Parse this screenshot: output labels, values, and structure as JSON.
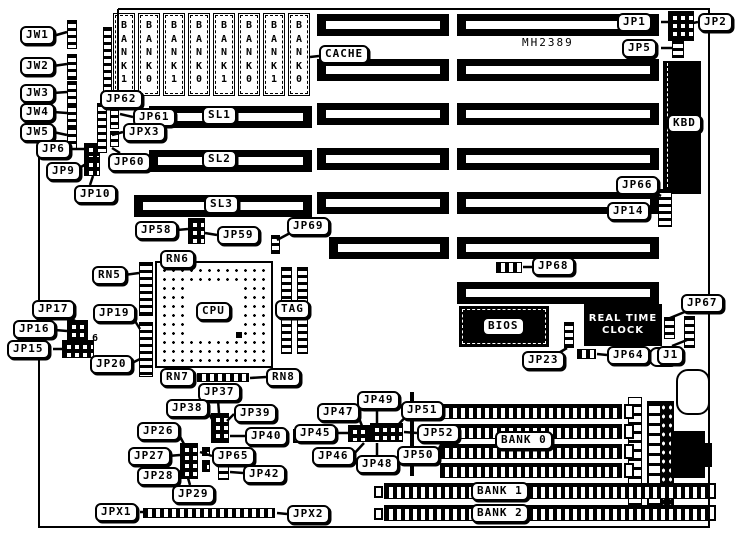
{
  "board": {
    "model_text": "MH2389"
  },
  "labels": {
    "rtc_line1": "REAL TIME",
    "rtc_line2": "CLOCK",
    "pin6": "6"
  },
  "memory": {
    "simm_slots": [
      "BANK1",
      "BANK0",
      "BANK1",
      "BANK0",
      "BANK1",
      "BANK0",
      "BANK1",
      "BANK0"
    ]
  },
  "callouts": [
    {
      "text": "JW1",
      "x": 20,
      "y": 26,
      "leader": [
        53,
        36,
        67,
        32
      ]
    },
    {
      "text": "JW2",
      "x": 20,
      "y": 57,
      "leader": [
        53,
        66,
        67,
        64
      ]
    },
    {
      "text": "JW3",
      "x": 20,
      "y": 84,
      "leader": [
        53,
        93,
        67,
        92
      ]
    },
    {
      "text": "JW4",
      "x": 20,
      "y": 103,
      "leader": [
        53,
        112,
        67,
        113
      ]
    },
    {
      "text": "JW5",
      "x": 20,
      "y": 123,
      "leader": [
        53,
        132,
        67,
        135
      ]
    },
    {
      "text": "JP6",
      "x": 36,
      "y": 140,
      "leader": [
        70,
        149,
        84,
        149
      ]
    },
    {
      "text": "JP9",
      "x": 46,
      "y": 162,
      "leader": [
        76,
        170,
        86,
        164
      ]
    },
    {
      "text": "JP10",
      "x": 74,
      "y": 185,
      "leader": [
        90,
        185,
        93,
        176
      ]
    },
    {
      "text": "JP62",
      "x": 100,
      "y": 90,
      "leader": null
    },
    {
      "text": "JP61",
      "x": 133,
      "y": 108,
      "leader": [
        133,
        117,
        120,
        114
      ]
    },
    {
      "text": "JPX3",
      "x": 123,
      "y": 123,
      "leader": [
        123,
        132,
        112,
        135
      ]
    },
    {
      "text": "JP60",
      "x": 108,
      "y": 153,
      "leader": [
        120,
        153,
        112,
        148
      ]
    },
    {
      "text": "SL1",
      "x": 202,
      "y": 106,
      "leader": null
    },
    {
      "text": "SL2",
      "x": 202,
      "y": 150,
      "leader": null
    },
    {
      "text": "SL3",
      "x": 204,
      "y": 195,
      "leader": null
    },
    {
      "text": "CACHE",
      "x": 319,
      "y": 45,
      "leader": [
        319,
        56,
        310,
        57
      ]
    },
    {
      "text": "JP1",
      "x": 617,
      "y": 13,
      "leader": [
        661,
        22,
        668,
        22
      ]
    },
    {
      "text": "JP2",
      "x": 698,
      "y": 13,
      "leader": [
        698,
        22,
        693,
        23
      ]
    },
    {
      "text": "JP5",
      "x": 622,
      "y": 39,
      "leader": [
        661,
        48,
        672,
        48
      ]
    },
    {
      "text": "JP58",
      "x": 135,
      "y": 221,
      "leader": [
        177,
        230,
        188,
        229
      ]
    },
    {
      "text": "JP59",
      "x": 217,
      "y": 226,
      "leader": [
        217,
        235,
        205,
        233
      ]
    },
    {
      "text": "JP69",
      "x": 287,
      "y": 217,
      "leader": [
        292,
        232,
        277,
        240
      ]
    },
    {
      "text": "RN6",
      "x": 160,
      "y": 250,
      "leader": null
    },
    {
      "text": "RN5",
      "x": 92,
      "y": 266,
      "leader": [
        124,
        275,
        139,
        273
      ]
    },
    {
      "text": "JP17",
      "x": 32,
      "y": 300,
      "leader": [
        70,
        318,
        75,
        321
      ]
    },
    {
      "text": "JP19",
      "x": 93,
      "y": 304,
      "leader": [
        130,
        313,
        140,
        329
      ]
    },
    {
      "text": "JP16",
      "x": 13,
      "y": 320,
      "leader": [
        55,
        330,
        67,
        331
      ]
    },
    {
      "text": "JP15",
      "x": 7,
      "y": 340,
      "leader": [
        53,
        349,
        62,
        349
      ]
    },
    {
      "text": "JP20",
      "x": 90,
      "y": 355,
      "leader": [
        130,
        364,
        140,
        359
      ]
    },
    {
      "text": "RN7",
      "x": 160,
      "y": 368,
      "leader": null
    },
    {
      "text": "RN8",
      "x": 266,
      "y": 368,
      "leader": [
        266,
        377,
        250,
        378
      ]
    },
    {
      "text": "JP37",
      "x": 198,
      "y": 383,
      "leader": [
        218,
        400,
        219,
        413
      ]
    },
    {
      "text": "JP38",
      "x": 166,
      "y": 399,
      "leader": [
        206,
        409,
        212,
        419
      ]
    },
    {
      "text": "JP39",
      "x": 234,
      "y": 404,
      "leader": [
        234,
        414,
        227,
        421
      ]
    },
    {
      "text": "JP40",
      "x": 245,
      "y": 427,
      "leader": [
        245,
        436,
        230,
        436
      ]
    },
    {
      "text": "JP26",
      "x": 137,
      "y": 422,
      "leader": [
        177,
        431,
        184,
        444
      ]
    },
    {
      "text": "JP27",
      "x": 128,
      "y": 447,
      "leader": [
        168,
        456,
        180,
        455
      ]
    },
    {
      "text": "JP65",
      "x": 212,
      "y": 447,
      "leader": [
        212,
        456,
        200,
        452
      ]
    },
    {
      "text": "JP28",
      "x": 137,
      "y": 467,
      "leader": [
        177,
        476,
        185,
        471
      ]
    },
    {
      "text": "JP42",
      "x": 243,
      "y": 465,
      "leader": [
        243,
        473,
        230,
        472
      ]
    },
    {
      "text": "JP29",
      "x": 172,
      "y": 485,
      "leader": [
        190,
        485,
        188,
        478
      ]
    },
    {
      "text": "JPX1",
      "x": 95,
      "y": 503,
      "leader": [
        140,
        512,
        147,
        512
      ]
    },
    {
      "text": "JPX2",
      "x": 287,
      "y": 505,
      "leader": [
        287,
        514,
        277,
        513
      ]
    },
    {
      "text": "JP47",
      "x": 317,
      "y": 403,
      "leader": [
        357,
        413,
        362,
        426
      ]
    },
    {
      "text": "JP49",
      "x": 357,
      "y": 391,
      "leader": [
        377,
        406,
        377,
        424
      ]
    },
    {
      "text": "JP51",
      "x": 401,
      "y": 401,
      "leader": [
        410,
        412,
        398,
        425
      ]
    },
    {
      "text": "JP45",
      "x": 294,
      "y": 424,
      "leader": [
        330,
        433,
        348,
        433
      ]
    },
    {
      "text": "JP52",
      "x": 417,
      "y": 424,
      "leader": [
        417,
        433,
        404,
        432
      ]
    },
    {
      "text": "JP46",
      "x": 312,
      "y": 447,
      "leader": [
        352,
        456,
        364,
        443
      ]
    },
    {
      "text": "JP48",
      "x": 356,
      "y": 455,
      "leader": [
        377,
        455,
        377,
        443
      ]
    },
    {
      "text": "JP50",
      "x": 397,
      "y": 446,
      "leader": [
        437,
        452,
        441,
        445
      ]
    },
    {
      "text": "BANK 0",
      "x": 495,
      "y": 431,
      "leader": null
    },
    {
      "text": "BANK 1",
      "x": 471,
      "y": 482,
      "leader": null
    },
    {
      "text": "BANK 2",
      "x": 471,
      "y": 504,
      "leader": null
    },
    {
      "text": "JP23",
      "x": 522,
      "y": 351,
      "leader": [
        552,
        357,
        567,
        348
      ]
    },
    {
      "text": "JP64",
      "x": 607,
      "y": 346,
      "leader": [
        607,
        355,
        597,
        354
      ]
    },
    {
      "text": "J1",
      "x": 657,
      "y": 346,
      "leader": [
        672,
        346,
        687,
        340
      ]
    },
    {
      "text": "JP67",
      "x": 681,
      "y": 294,
      "leader": [
        687,
        311,
        670,
        318
      ]
    },
    {
      "text": "JP68",
      "x": 532,
      "y": 257,
      "leader": [
        532,
        267,
        523,
        267
      ]
    },
    {
      "text": "JP66",
      "x": 616,
      "y": 176,
      "leader": [
        650,
        190,
        661,
        196
      ]
    },
    {
      "text": "JP14",
      "x": 607,
      "y": 202,
      "leader": [
        647,
        211,
        658,
        211
      ]
    },
    {
      "text": "CPU",
      "x": 196,
      "y": 302,
      "leader": null
    },
    {
      "text": "TAG",
      "x": 275,
      "y": 300,
      "leader": null
    },
    {
      "text": "BIOS",
      "x": 482,
      "y": 317,
      "leader": null
    },
    {
      "text": "KBD",
      "x": 667,
      "y": 114,
      "leader": null
    }
  ]
}
